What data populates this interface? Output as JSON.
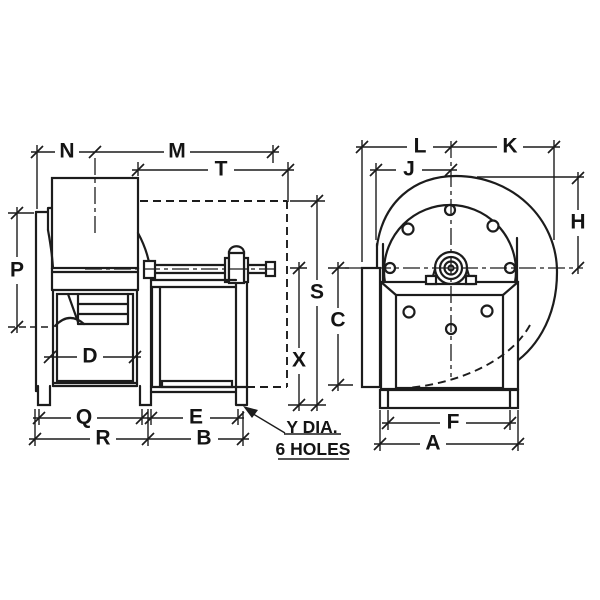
{
  "drawing": {
    "type": "blower dimensional line drawing, two orthographic views",
    "colors": {
      "line": "#1c1c1c",
      "background": "#ffffff"
    },
    "side_view": {
      "dim_labels": {
        "N": "N",
        "M": "M",
        "T": "T",
        "P": "P",
        "D": "D",
        "Q": "Q",
        "E": "E",
        "R": "R",
        "B": "B",
        "S": "S",
        "X": "X"
      }
    },
    "front_view": {
      "dim_labels": {
        "L": "L",
        "K": "K",
        "J": "J",
        "H": "H",
        "C": "C",
        "F": "F",
        "A": "A"
      }
    },
    "callout": {
      "line1": "Y DIA.",
      "line2": "6 HOLES"
    }
  }
}
